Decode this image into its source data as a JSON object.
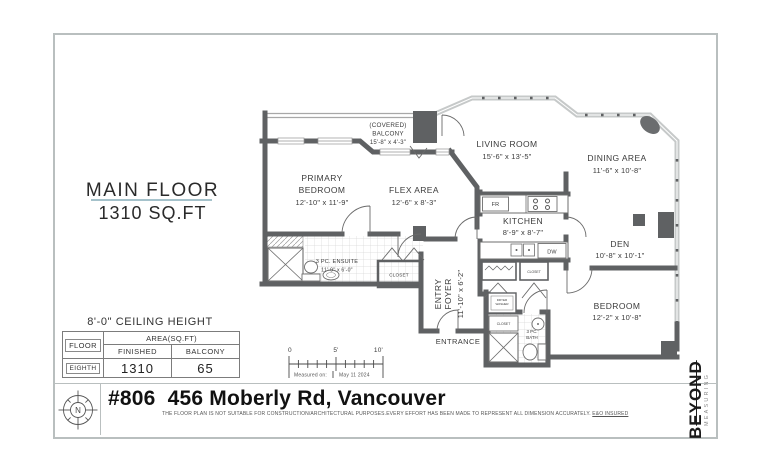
{
  "header": {
    "floor_label": "MAIN FLOOR",
    "floor_area": "1310 SQ.FT"
  },
  "rooms": {
    "balcony_l1": "(COVERED)",
    "balcony_l2": "BALCONY",
    "balcony_dims": "15'-8\" x 4'-3\"",
    "primary_l1": "PRIMARY",
    "primary_l2": "BEDROOM",
    "primary_dims": "12'-10\" x 11'-9\"",
    "flex": "FLEX AREA",
    "flex_dims": "12'-6\" x 8'-3\"",
    "living": "LIVING ROOM",
    "living_dims": "15'-6\" x 13'-5\"",
    "dining": "DINING AREA",
    "dining_dims": "11'-6\" x 10'-8\"",
    "kitchen": "KITCHEN",
    "kitchen_dims": "8'-9\" x 8'-7\"",
    "den": "DEN",
    "den_dims": "10'-8\" x 10'-1\"",
    "bedroom": "BEDROOM",
    "bedroom_dims": "12'-2\" x 10'-8\"",
    "foyer_l1": "ENTRY",
    "foyer_l2": "FOYER",
    "foyer_dims": "11'-10\" x 6'-2\"",
    "ensuite": "3 PC. ENSUITE",
    "ensuite_dims": "11'-9\" x 6'-0\"",
    "bath_l1": "3 PC.",
    "bath_l2": "BATH",
    "entrance": "ENTRANCE"
  },
  "fixtures": {
    "fridge": "FR",
    "dishwasher": "DW",
    "closet_hall": "CLOSET",
    "closet_kitchen": "CLOSET",
    "closet_bath": "CLOSET",
    "dryer": "DRYER",
    "washer": "WASHER"
  },
  "info_table": {
    "ceiling": "8'-0\" CEILING HEIGHT",
    "floor_col": "FLOOR",
    "area_col": "AREA(SQ.FT)",
    "finished_col": "FINISHED",
    "balcony_col": "BALCONY",
    "row_floor": "EIGHTH",
    "row_finished": "1310",
    "row_balcony": "65"
  },
  "scale_bar": {
    "t0": "0",
    "t5": "5'",
    "t10": "10'",
    "measured_label": "Measured on:",
    "measured_date": "May 11 2024"
  },
  "footer": {
    "title": "#806  456 Moberly Rd, Vancouver",
    "disclaimer": "THE  FLOOR PLAN  IS NOT SUITABLE FOR CONSTRUCTION/ARCHITECTURAL PURPOSES.EVERY EFFORT HAS BEEN MADE TO REPRESENT ALL DIMENSION ACCURATELY. ",
    "disclaimer_emphasis": "E&O INSURED",
    "compass": "N"
  },
  "brand": {
    "initial": "B",
    "rest": "EYOND",
    "tagline": "MEASURING"
  },
  "colors": {
    "wall": "#5f6163",
    "window": "#c6c9c9",
    "accent_underline": "#a5c2cb",
    "frame": "#b9bfbf"
  }
}
